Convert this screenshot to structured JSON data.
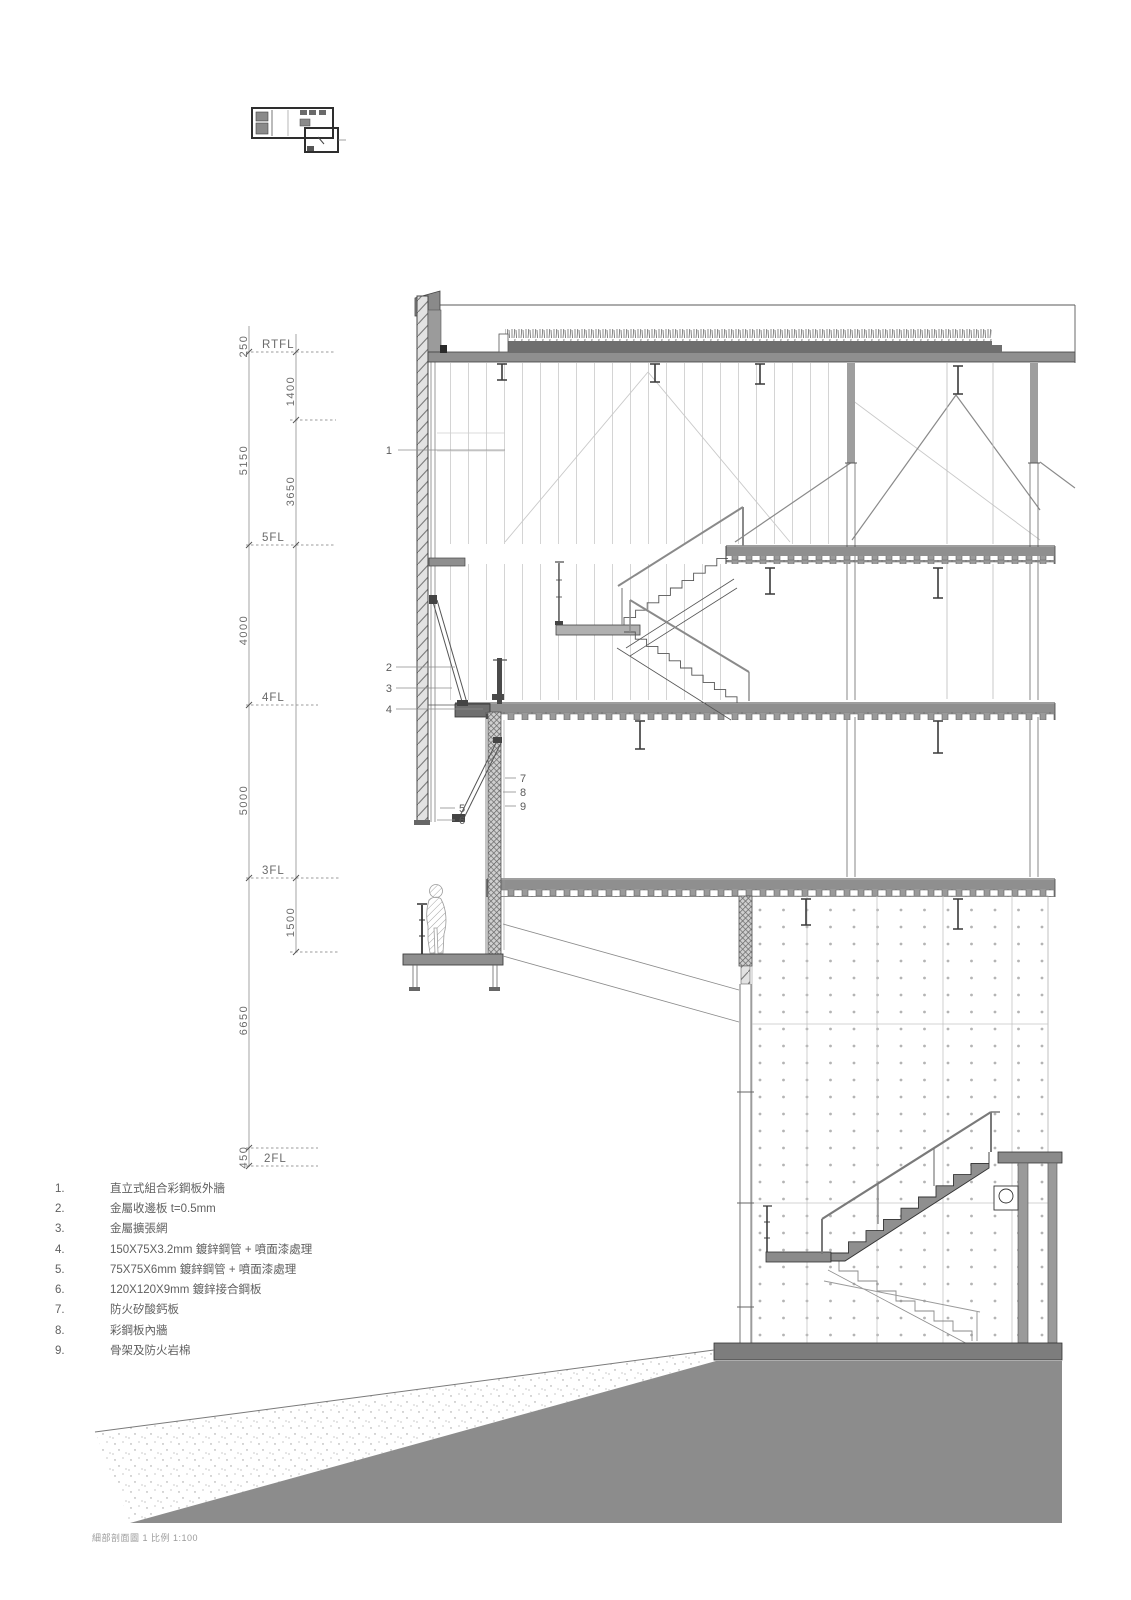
{
  "drawing": {
    "caption": "細部剖面圖 1 比例 1:100",
    "levels": [
      "RTFL",
      "5FL",
      "4FL",
      "3FL",
      "2FL"
    ],
    "dims_outer": [
      "250",
      "5150",
      "4000",
      "5000",
      "6650",
      "450"
    ],
    "dims_inner": [
      "1400",
      "3650",
      "1500"
    ],
    "callouts": [
      "1",
      "2",
      "3",
      "4",
      "5",
      "6",
      "7",
      "8",
      "9"
    ],
    "legend": [
      {
        "num": "1.",
        "text": "直立式組合彩鋼板外牆"
      },
      {
        "num": "2.",
        "text": "金屬收邊板 t=0.5mm"
      },
      {
        "num": "3.",
        "text": "金屬擴張網"
      },
      {
        "num": "4.",
        "text": "150X75X3.2mm 鍍鋅鋼管 + 噴面漆處理"
      },
      {
        "num": "5.",
        "text": "75X75X6mm 鍍鋅鋼管 + 噴面漆處理"
      },
      {
        "num": "6.",
        "text": "120X120X9mm 鍍鋅接合鋼板"
      },
      {
        "num": "7.",
        "text": "防火矽酸鈣板"
      },
      {
        "num": "8.",
        "text": "彩鋼板內牆"
      },
      {
        "num": "9.",
        "text": "骨架及防火岩棉"
      }
    ],
    "colors": {
      "slab": "#8f8f8f",
      "terrain": "#8c8c8c",
      "line_dark": "#454545",
      "line_light": "#cfcfcf",
      "text": "#5a5a5a"
    }
  }
}
